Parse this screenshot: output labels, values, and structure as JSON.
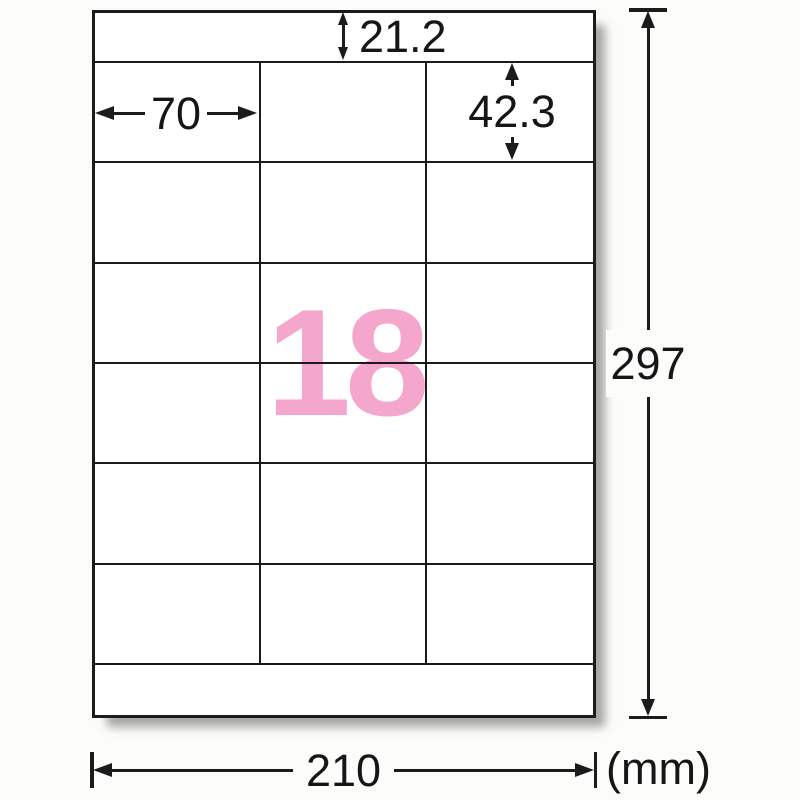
{
  "sheet": {
    "label_count": "18",
    "columns": 3,
    "rows": 6
  },
  "dimensions": {
    "top_margin": "21.2",
    "label_width": "70",
    "label_height": "42.3",
    "page_height": "297",
    "page_width": "210",
    "unit": "(mm)"
  },
  "colors": {
    "line": "#1b1b1b",
    "label_count_pink": "#f4a6cd",
    "background": "#fcfcfa",
    "sheet": "#ffffff"
  }
}
